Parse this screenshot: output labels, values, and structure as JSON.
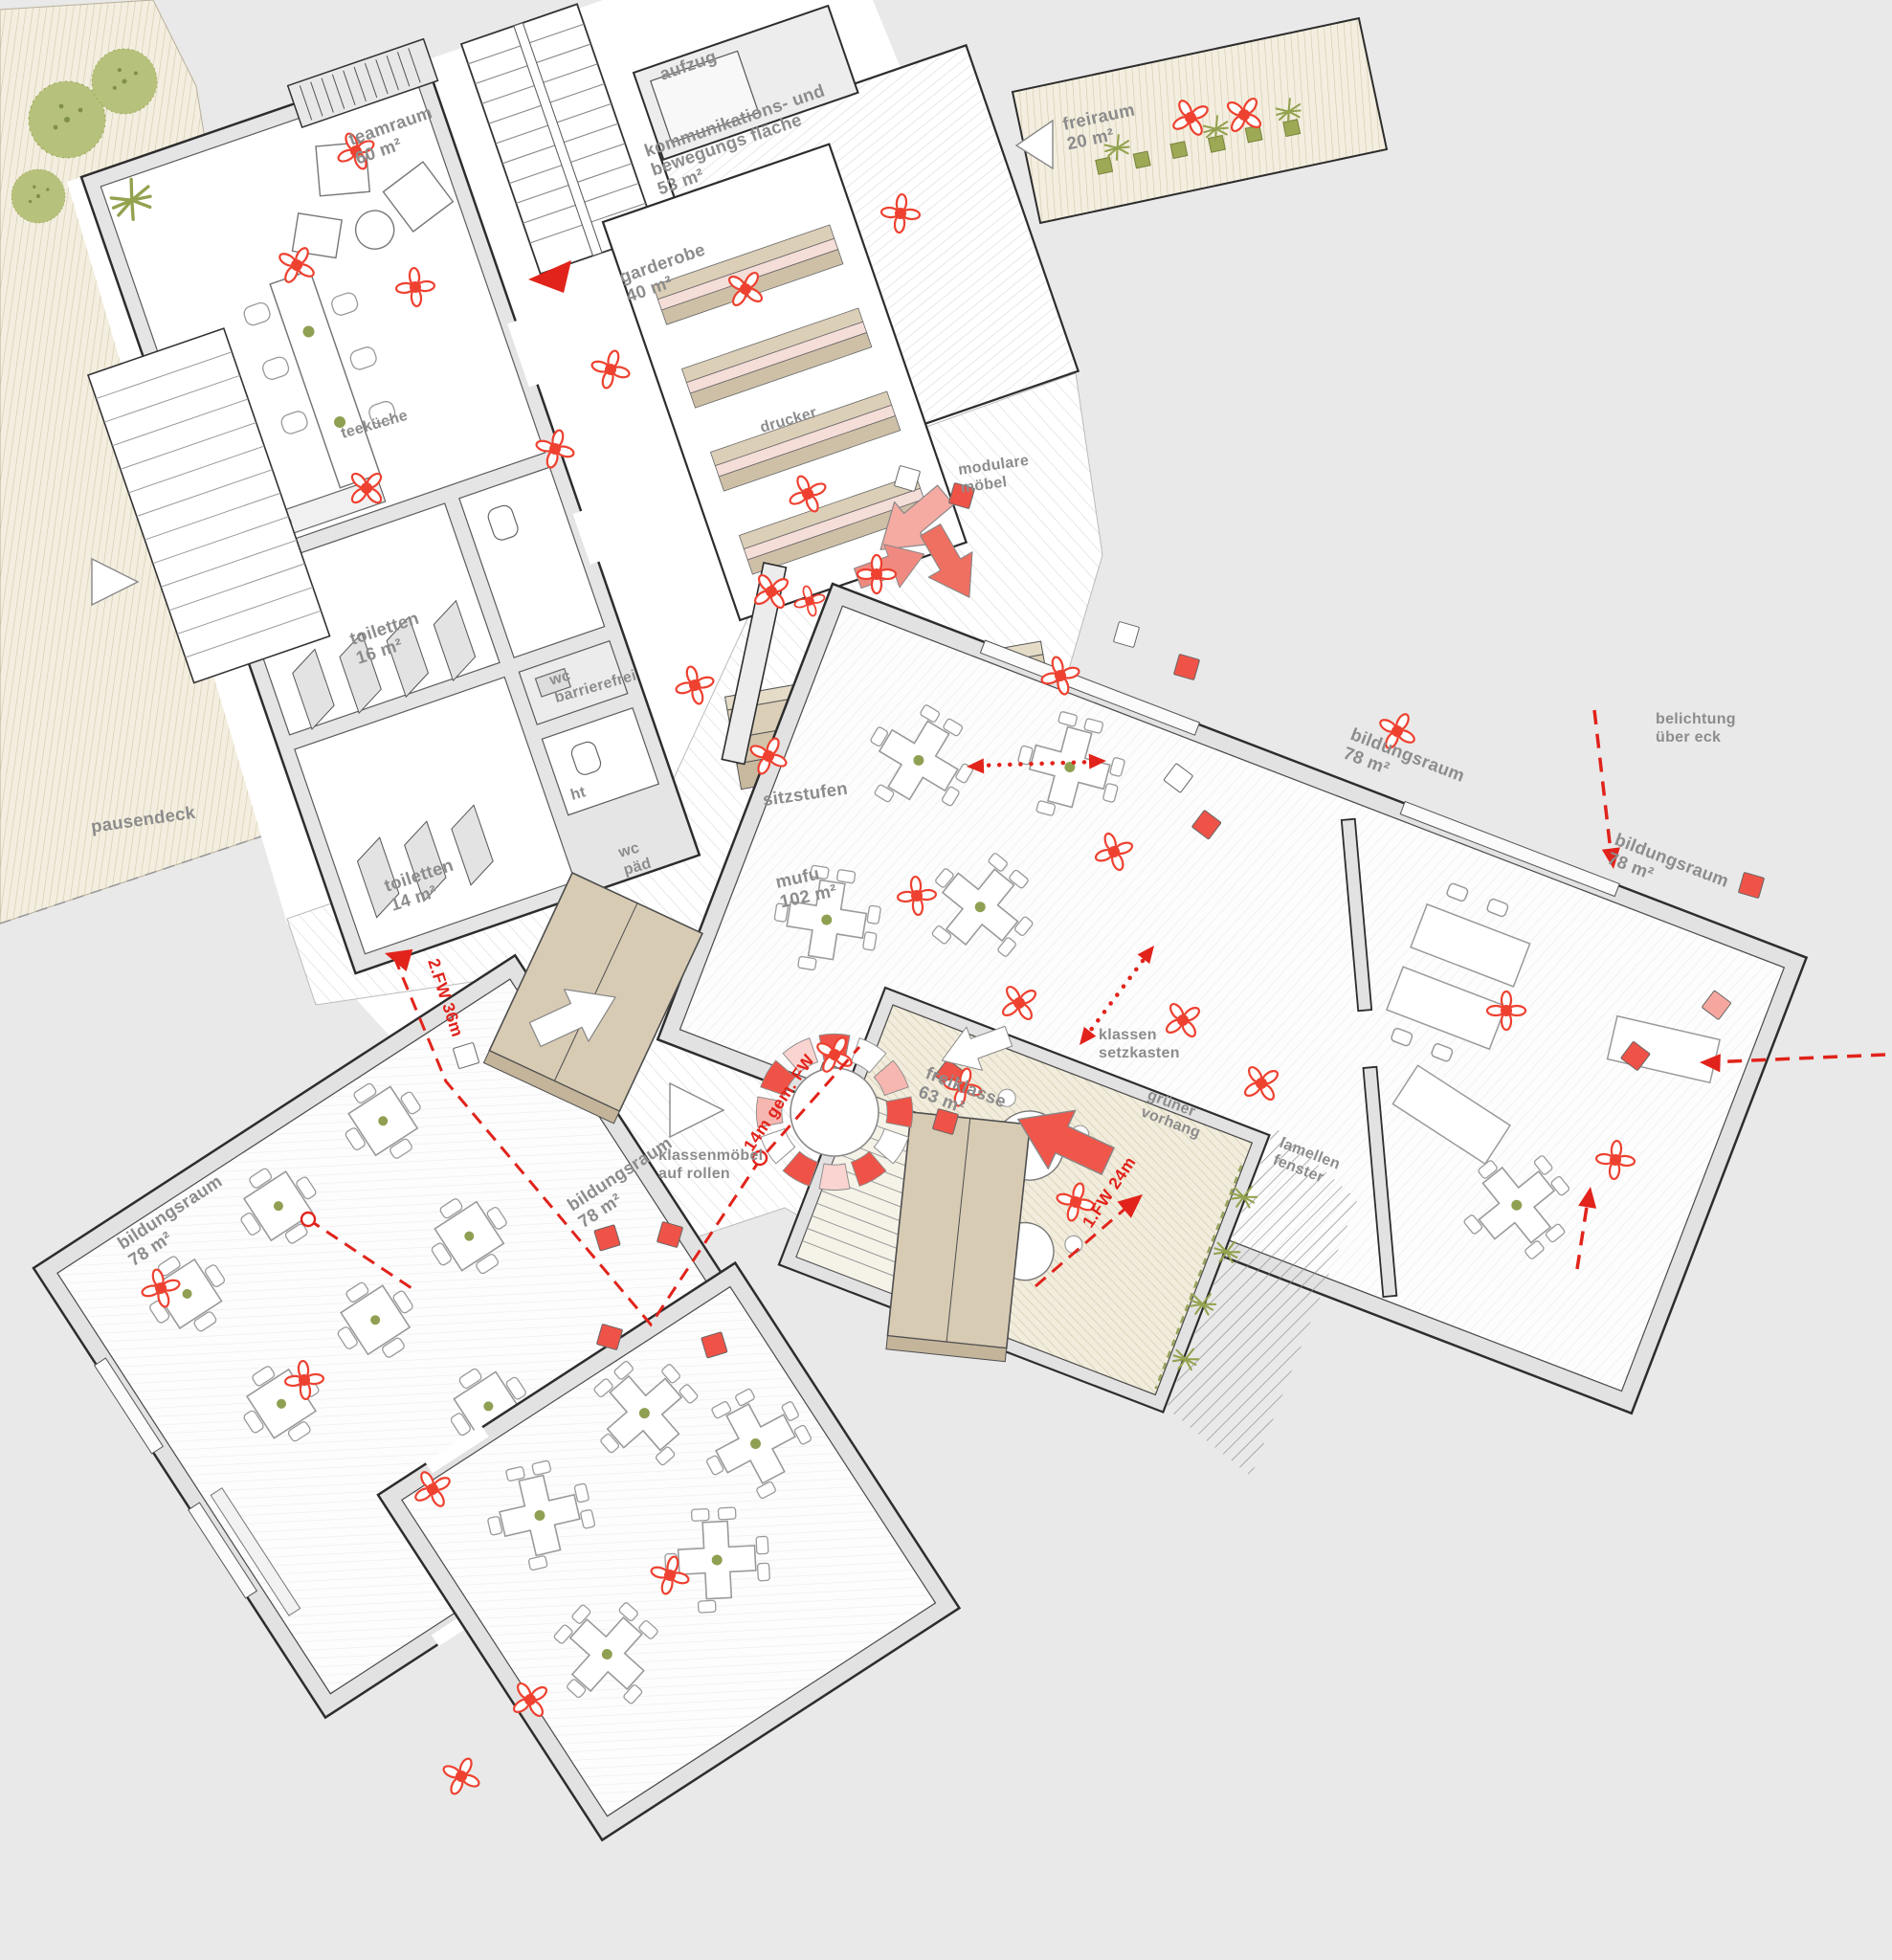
{
  "colors": {
    "background": "#e9e9e9",
    "floor_white": "#ffffff",
    "wall_fill": "#e3e3e3",
    "outline": "#2d2d2d",
    "label_gray": "#8c8c8c",
    "accent_red": "#e1231b",
    "chair_red": "#ee4130",
    "cube_red": "#ef5347",
    "cube_pink": "#f5a79f",
    "wood_tan": "#d8cbb4",
    "wood_floor": "#f3eedf",
    "plant_green": "#93a24f"
  },
  "rooms": {
    "teamraum": {
      "name": "teamraum",
      "area": "60 m²"
    },
    "aufzug": {
      "name": "aufzug"
    },
    "kommunikationsflaeche": {
      "name_line1": "kommunikations- und",
      "name_line2": "bewegungs fläche",
      "area": "53 m²"
    },
    "freiraum": {
      "name": "freiraum",
      "area": "20 m²"
    },
    "garderobe": {
      "name": "garderobe",
      "area": "40 m²"
    },
    "toiletten_16": {
      "name": "toiletten",
      "area": "16 m²"
    },
    "wc_barrierefrei": {
      "name_line1": "wc",
      "name_line2": "barrierefrei"
    },
    "ht": {
      "name": "ht"
    },
    "wc_paed": {
      "name_line1": "wc",
      "name_line2": "päd"
    },
    "toiletten_14": {
      "name": "toiletten",
      "area": "14 m²"
    },
    "mufu": {
      "name": "mufu",
      "area": "102 m²"
    },
    "bildungsraum_nordost": {
      "name": "bildungsraum",
      "area": "78 m²"
    },
    "bildungsraum_ost": {
      "name": "bildungsraum",
      "area": "78 m²"
    },
    "bildungsraum_suedwest": {
      "name": "bildungsraum",
      "area": "78 m²"
    },
    "bildungsraum_sued": {
      "name": "bildungsraum",
      "area": "78 m²"
    },
    "freiklasse": {
      "name": "freiklasse",
      "area": "63 m²"
    },
    "pausendeck": {
      "name": "pausendeck"
    }
  },
  "features": {
    "teekueche": {
      "name": "teeküche"
    },
    "drucker": {
      "name": "drucker"
    },
    "sitzstufen": {
      "name": "sitzstufen"
    },
    "modulare_moebel": {
      "line1": "modulare",
      "line2": "möbel"
    },
    "klassen_setzkasten": {
      "line1": "klassen",
      "line2": "setzkasten"
    },
    "klassenmoebel": {
      "line1": "klassenmöbel",
      "line2": "auf rollen"
    },
    "belichtung": {
      "line1": "belichtung",
      "line2": "über eck"
    },
    "gruener_vorhang": {
      "line1": "grüner",
      "line2": "vorhang"
    },
    "lamellen_fenster": {
      "line1": "lamellen",
      "line2": "fenster"
    }
  },
  "escape_routes": {
    "fw2": "2.FW 36m",
    "fw1": "1.FW 24m",
    "fw_gem": "14m gem. FW"
  }
}
